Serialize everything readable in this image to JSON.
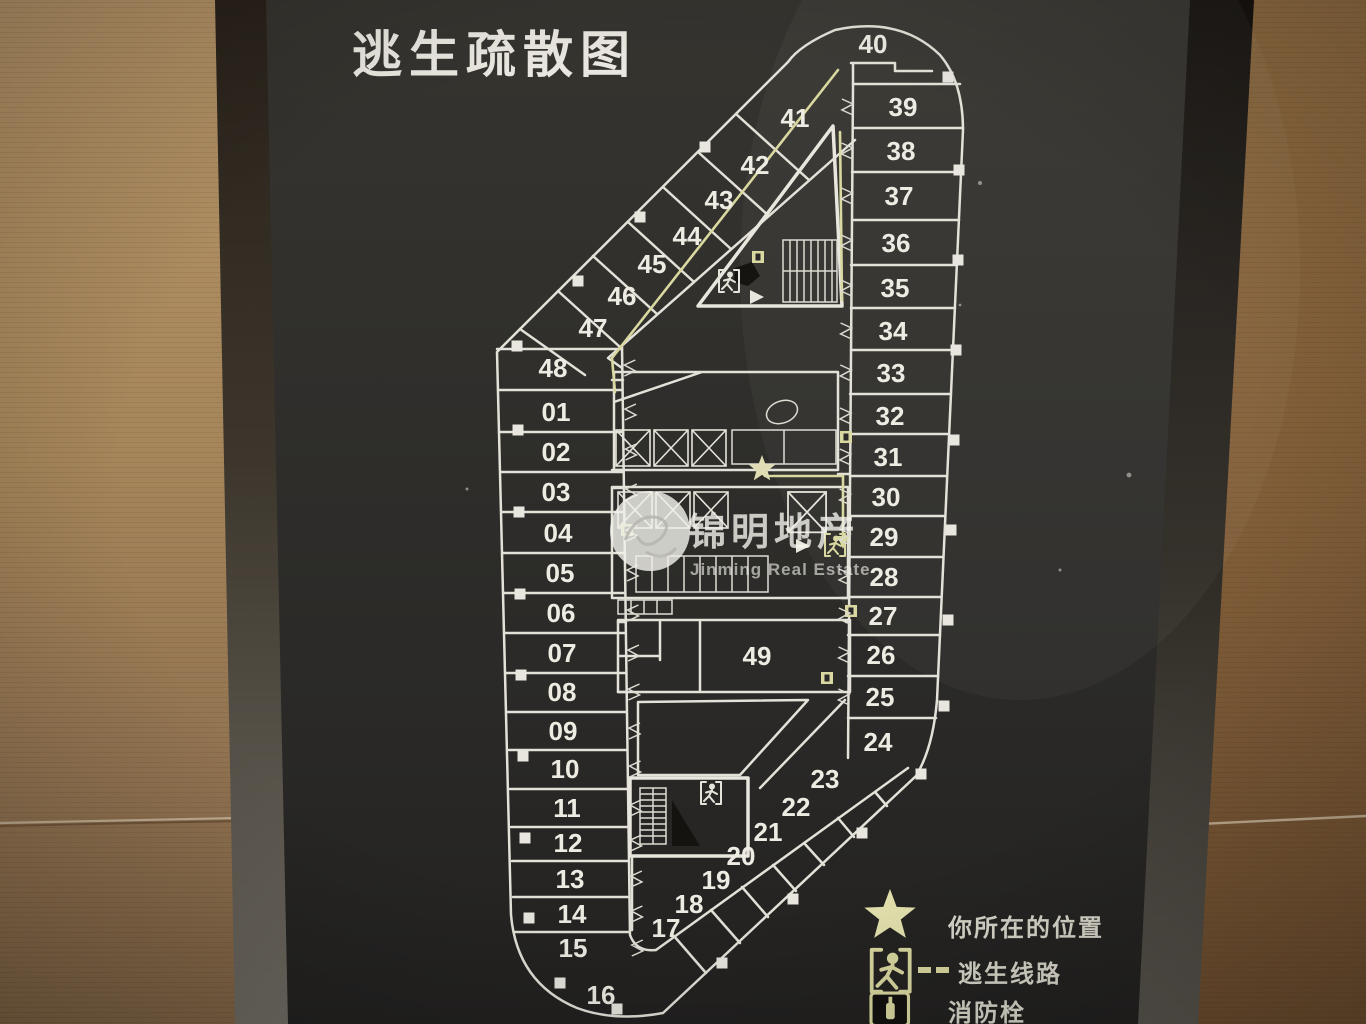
{
  "sign": {
    "title": "逃生疏散图"
  },
  "legend": {
    "items": [
      {
        "icon": "star-icon",
        "label": "你所在的位置"
      },
      {
        "icon": "running-man-icon",
        "label": "逃生线路"
      },
      {
        "icon": "fire-hydrant-icon",
        "label": "消防栓"
      }
    ]
  },
  "watermark": {
    "name": "锦明地产",
    "name_en": "Jinming Real Estate"
  },
  "plan": {
    "star": {
      "x": 762,
      "y": 469
    },
    "rooms": [
      {
        "label": "01",
        "x": 556,
        "y": 412
      },
      {
        "label": "02",
        "x": 556,
        "y": 452
      },
      {
        "label": "03",
        "x": 556,
        "y": 492
      },
      {
        "label": "04",
        "x": 558,
        "y": 533
      },
      {
        "label": "05",
        "x": 560,
        "y": 573
      },
      {
        "label": "06",
        "x": 561,
        "y": 613
      },
      {
        "label": "07",
        "x": 562,
        "y": 653
      },
      {
        "label": "08",
        "x": 562,
        "y": 692
      },
      {
        "label": "09",
        "x": 563,
        "y": 731
      },
      {
        "label": "10",
        "x": 565,
        "y": 769
      },
      {
        "label": "11",
        "x": 567,
        "y": 808
      },
      {
        "label": "12",
        "x": 568,
        "y": 843
      },
      {
        "label": "13",
        "x": 570,
        "y": 879
      },
      {
        "label": "14",
        "x": 572,
        "y": 914
      },
      {
        "label": "15",
        "x": 573,
        "y": 948
      },
      {
        "label": "16",
        "x": 601,
        "y": 995
      },
      {
        "label": "17",
        "x": 666,
        "y": 928
      },
      {
        "label": "18",
        "x": 689,
        "y": 904
      },
      {
        "label": "19",
        "x": 716,
        "y": 880
      },
      {
        "label": "20",
        "x": 741,
        "y": 856
      },
      {
        "label": "21",
        "x": 768,
        "y": 832
      },
      {
        "label": "22",
        "x": 796,
        "y": 807
      },
      {
        "label": "23",
        "x": 825,
        "y": 779
      },
      {
        "label": "24",
        "x": 878,
        "y": 742
      },
      {
        "label": "25",
        "x": 880,
        "y": 697
      },
      {
        "label": "26",
        "x": 881,
        "y": 655
      },
      {
        "label": "27",
        "x": 883,
        "y": 616
      },
      {
        "label": "28",
        "x": 884,
        "y": 577
      },
      {
        "label": "29",
        "x": 884,
        "y": 537
      },
      {
        "label": "30",
        "x": 886,
        "y": 497
      },
      {
        "label": "31",
        "x": 888,
        "y": 457
      },
      {
        "label": "32",
        "x": 890,
        "y": 416
      },
      {
        "label": "33",
        "x": 891,
        "y": 373
      },
      {
        "label": "34",
        "x": 893,
        "y": 331
      },
      {
        "label": "35",
        "x": 895,
        "y": 288
      },
      {
        "label": "36",
        "x": 896,
        "y": 243
      },
      {
        "label": "37",
        "x": 899,
        "y": 196
      },
      {
        "label": "38",
        "x": 901,
        "y": 151
      },
      {
        "label": "39",
        "x": 903,
        "y": 107
      },
      {
        "label": "40",
        "x": 873,
        "y": 44
      },
      {
        "label": "41",
        "x": 795,
        "y": 118
      },
      {
        "label": "42",
        "x": 755,
        "y": 165
      },
      {
        "label": "43",
        "x": 719,
        "y": 200
      },
      {
        "label": "44",
        "x": 687,
        "y": 236
      },
      {
        "label": "45",
        "x": 652,
        "y": 264
      },
      {
        "label": "46",
        "x": 622,
        "y": 296
      },
      {
        "label": "47",
        "x": 593,
        "y": 328
      },
      {
        "label": "48",
        "x": 553,
        "y": 368
      },
      {
        "label": "49",
        "x": 757,
        "y": 656
      }
    ]
  },
  "colors": {
    "board": "#2e2d2b",
    "plan_line": "#e3e1d8",
    "escape_route": "#d9d8a0",
    "star": "#e4e1ae",
    "wood_left": "#a5855a",
    "wood_right": "#815e39"
  }
}
